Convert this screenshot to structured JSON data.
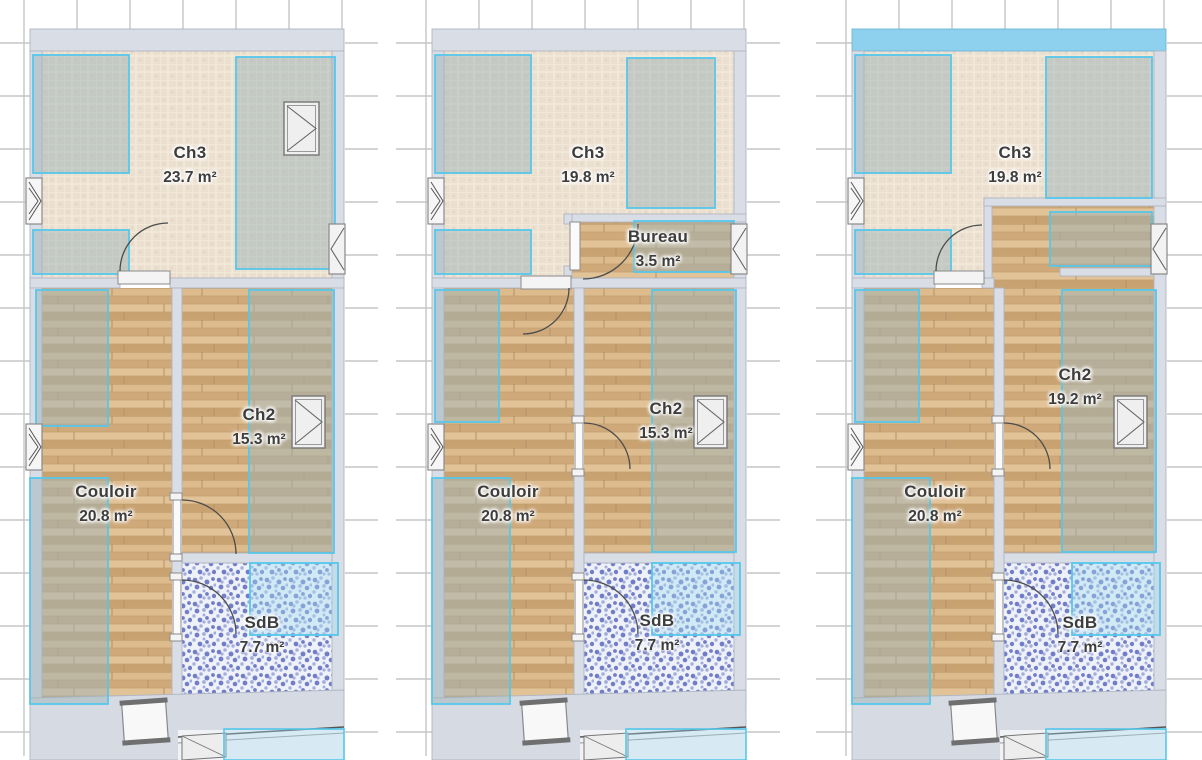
{
  "app_context": "floor-plan-comparison",
  "unit": "m²",
  "colors": {
    "selection_cyan": "#55C7EA",
    "highlighted_wall_blue": "#8ED1EF",
    "wall_gray": "#D9DDE6",
    "landing_gray": "#D5DAE3",
    "carpet_beige": "#EBDFCF",
    "wood_tan": "#D6B383",
    "tile_blue": "#5D68C0",
    "zone_overlay": "#9FB4B8",
    "grid_tick_gray": "#C6C6C6",
    "label_text": "#3D3D3D"
  },
  "plans": [
    {
      "id": "plan-1",
      "rooms": [
        {
          "name": "Ch3",
          "area": "23.7 m²"
        },
        {
          "name": "Ch2",
          "area": "15.3 m²"
        },
        {
          "name": "Couloir",
          "area": "20.8 m²"
        },
        {
          "name": "SdB",
          "area": "7.7 m²"
        }
      ]
    },
    {
      "id": "plan-2",
      "rooms": [
        {
          "name": "Ch3",
          "area": "19.8 m²"
        },
        {
          "name": "Bureau",
          "area": "3.5 m²"
        },
        {
          "name": "Ch2",
          "area": "15.3 m²"
        },
        {
          "name": "Couloir",
          "area": "20.8 m²"
        },
        {
          "name": "SdB",
          "area": "7.7 m²"
        }
      ]
    },
    {
      "id": "plan-3",
      "rooms": [
        {
          "name": "Ch3",
          "area": "19.8 m²"
        },
        {
          "name": "Ch2",
          "area": "19.2 m²"
        },
        {
          "name": "Couloir",
          "area": "20.8 m²"
        },
        {
          "name": "SdB",
          "area": "7.7 m²"
        }
      ]
    }
  ]
}
